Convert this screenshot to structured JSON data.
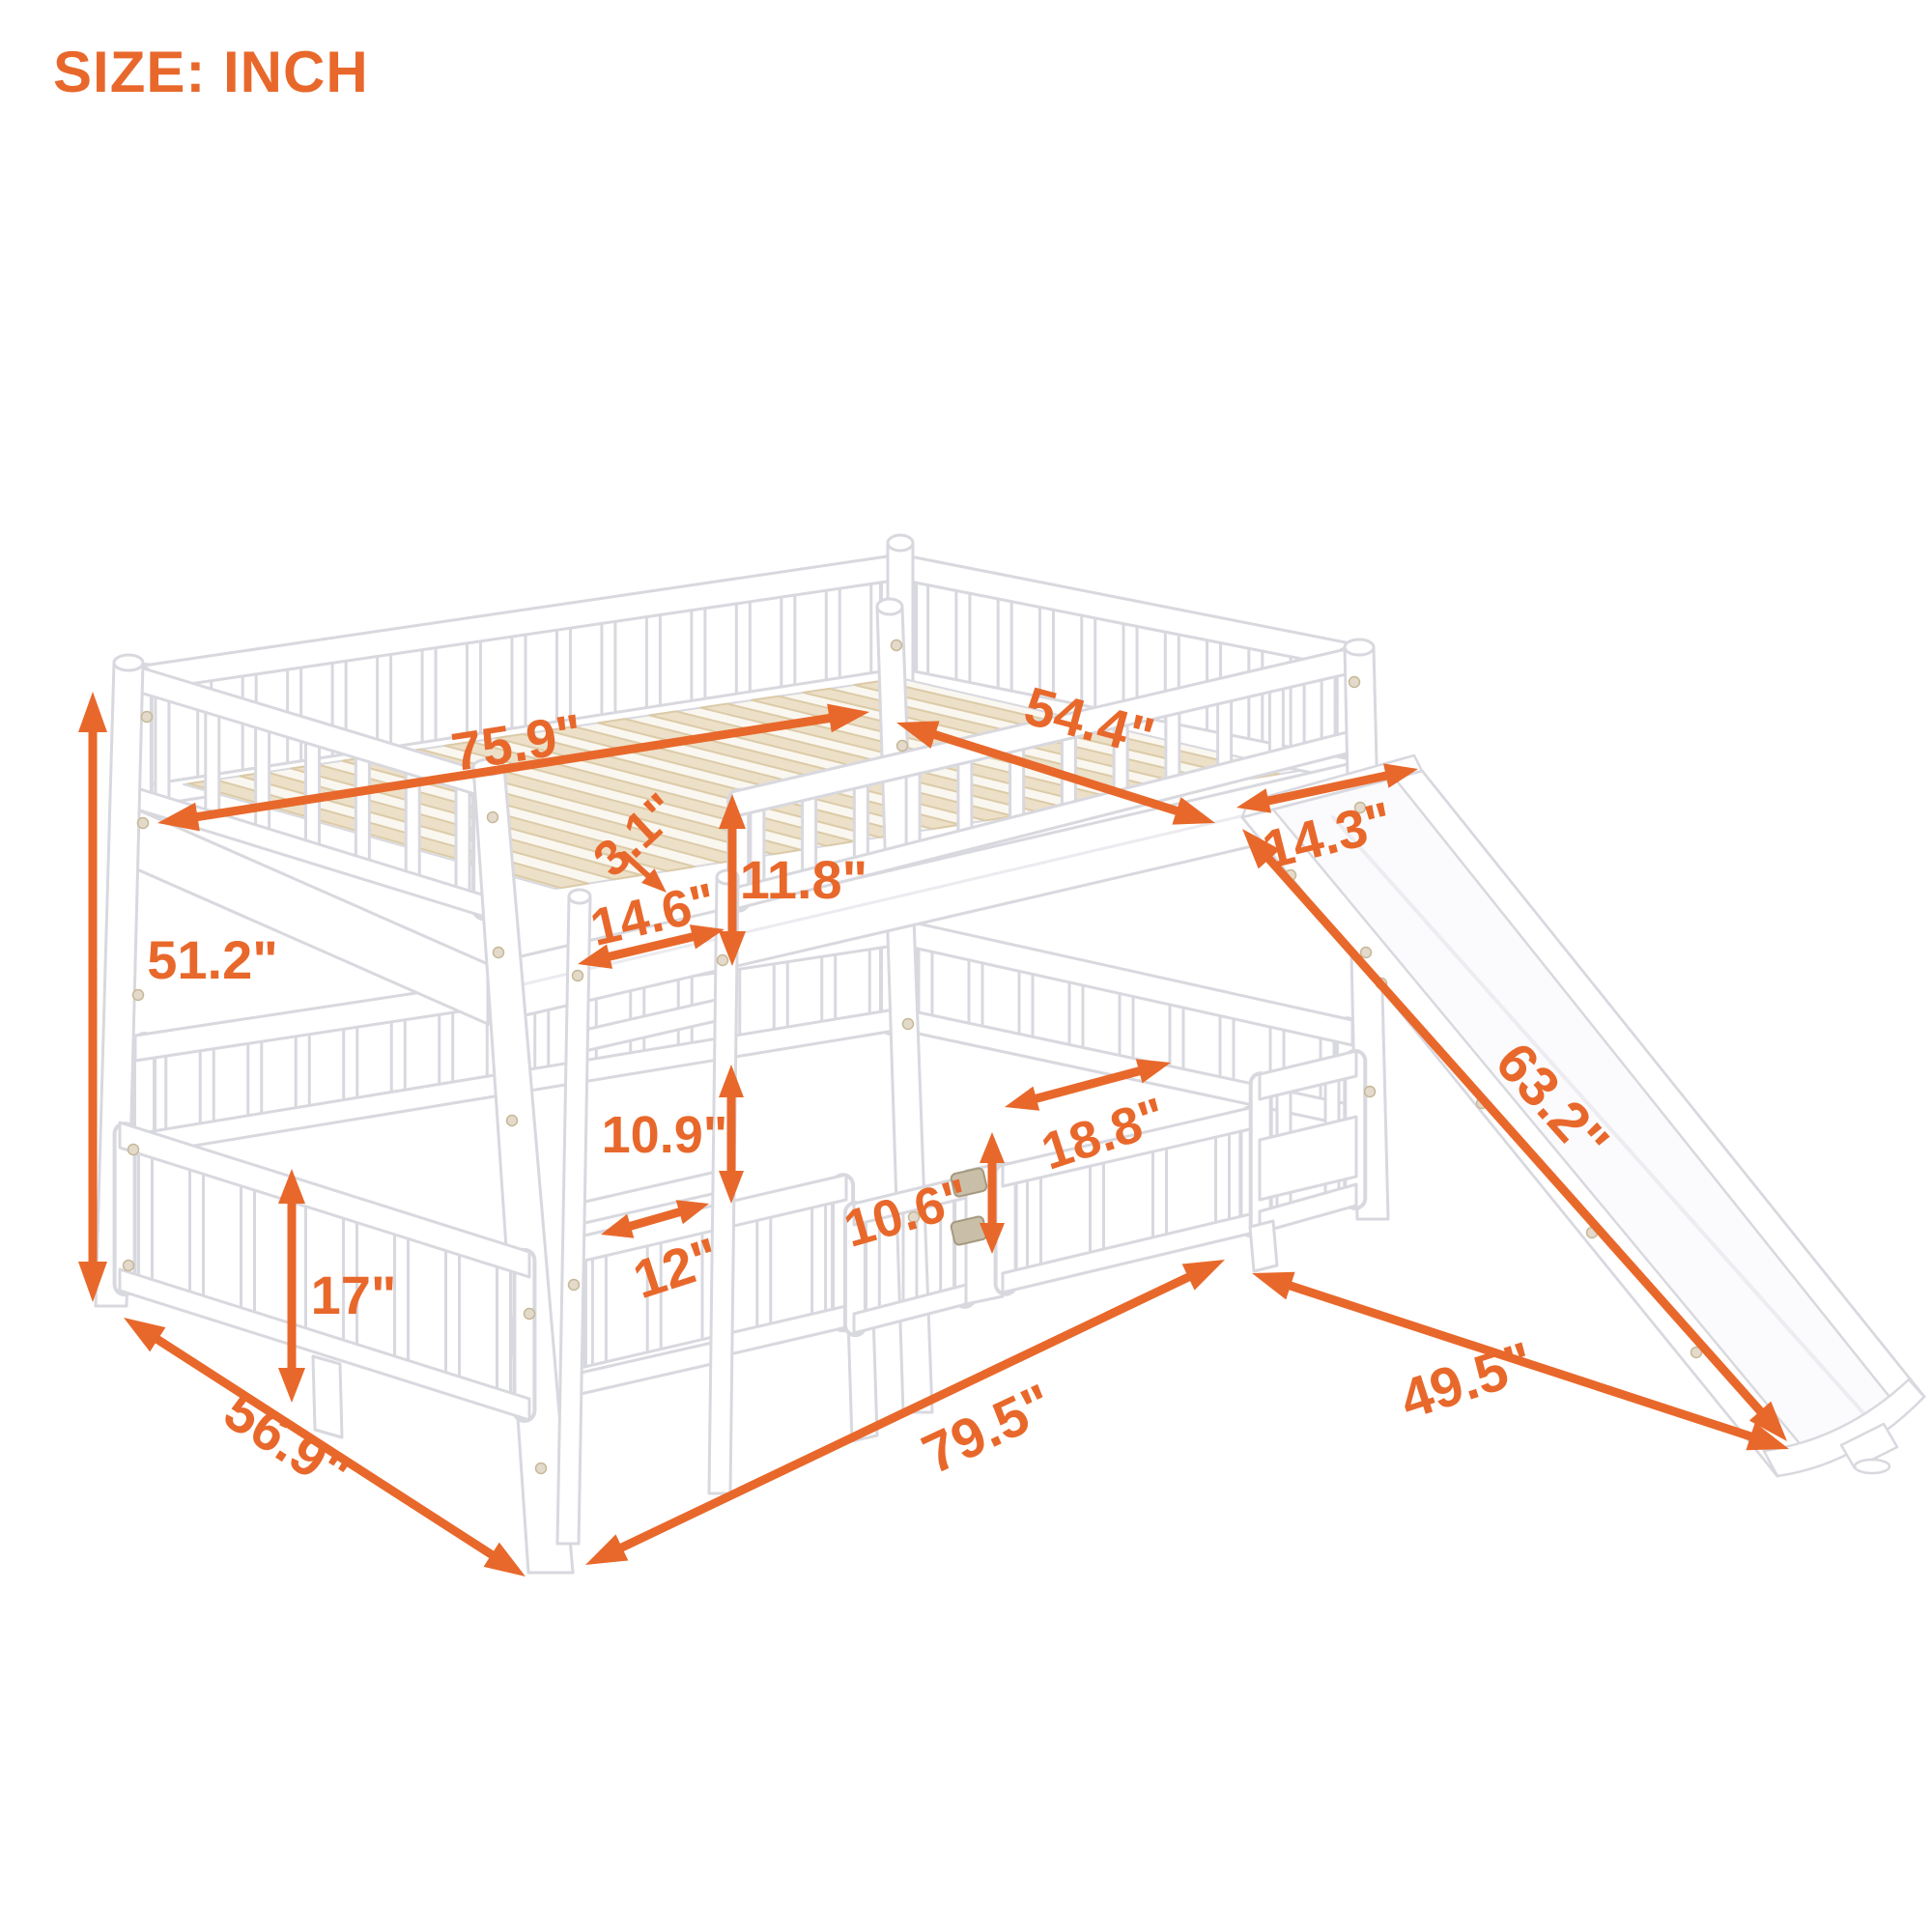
{
  "title": "SIZE: INCH",
  "unit": "inch",
  "colors": {
    "accent": "#E8682B",
    "wood_slat": "#EDE0C8",
    "frame_white": "#FFFFFF",
    "frame_outline": "#D8D8DF"
  },
  "dimensions": {
    "upper_bed_length": {
      "label": "75.9\"",
      "value": 75.9
    },
    "upper_bed_width": {
      "label": "54.4\"",
      "value": 54.4
    },
    "slat_thickness": {
      "label": "3.1\"",
      "value": 3.1
    },
    "upper_guardrail_height": {
      "label": "11.8\"",
      "value": 11.8
    },
    "upper_side_section": {
      "label": "14.6\"",
      "value": 14.6
    },
    "slide_width": {
      "label": "14.3\"",
      "value": 14.3
    },
    "total_height": {
      "label": "51.2\"",
      "value": 51.2
    },
    "ladder_step_spacing": {
      "label": "10.9\"",
      "value": 10.9
    },
    "lower_guardrail_height": {
      "label": "17\"",
      "value": 17
    },
    "ladder_width": {
      "label": "12\"",
      "value": 12
    },
    "gate_height": {
      "label": "10.6\"",
      "value": 10.6
    },
    "gate_width": {
      "label": "18.8\"",
      "value": 18.8
    },
    "slide_length": {
      "label": "63.2\"",
      "value": 63.2
    },
    "total_width": {
      "label": "56.9\"",
      "value": 56.9
    },
    "total_length": {
      "label": "79.5\"",
      "value": 79.5
    },
    "slide_floor_distance": {
      "label": "49.5\"",
      "value": 49.5
    }
  }
}
